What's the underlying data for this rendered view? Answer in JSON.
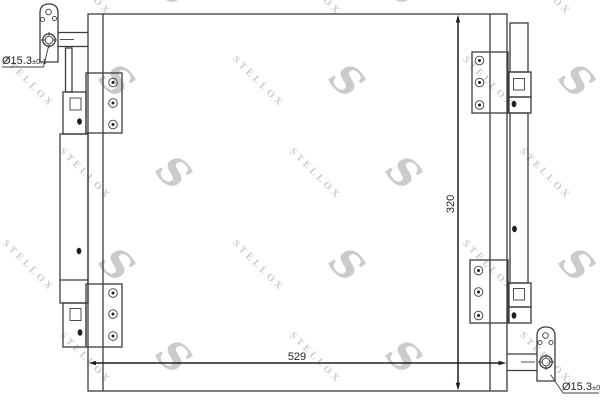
{
  "watermark": {
    "logo": "S",
    "text": "STELLOX"
  },
  "dimensions": {
    "width": {
      "value": "529"
    },
    "height": {
      "value": "320"
    }
  },
  "ports": {
    "top_left": {
      "diameter": "Ø15.3",
      "tolerance": "±0.1"
    },
    "bottom_right": {
      "diameter": "Ø15.3",
      "tolerance": "±0.1"
    }
  },
  "colors": {
    "line": "#3c3c3c",
    "dim": "#1f1f1f",
    "text": "#1f1f1f",
    "wm": "#cbcbcb",
    "bg": "#ffffff"
  }
}
